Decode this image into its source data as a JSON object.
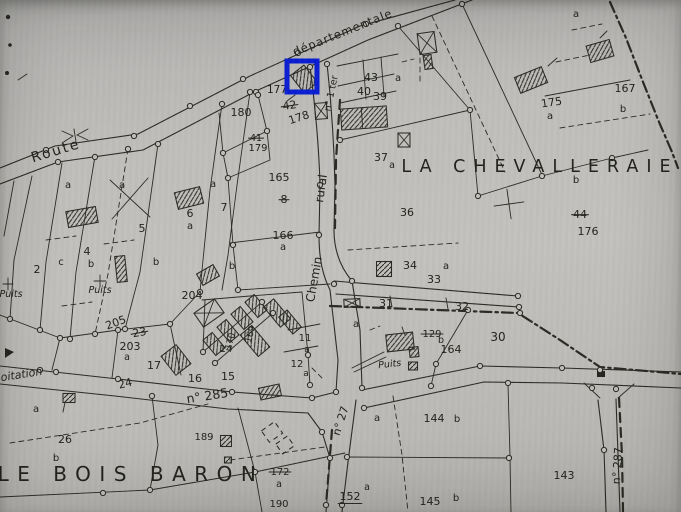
{
  "colors": {
    "paper": "#bfbebb",
    "ink": "#2b2b25",
    "highlight": "#0a1ed2"
  },
  "highlight": {
    "x": 287,
    "y": 61,
    "width": 30,
    "height": 31,
    "stroke_width": 5
  },
  "place_names": [
    {
      "t": "LA CHEVALLERAIE",
      "x": 540,
      "y": 172,
      "s": 17.5,
      "sp": 8,
      "n": "place-la-chevalleraie"
    },
    {
      "t": "LE BOIS BARON",
      "x": 131,
      "y": 481,
      "s": 20,
      "sp": 8.5,
      "n": "place-le-bois-baron"
    }
  ],
  "road_labels": [
    {
      "t": "Route",
      "x": 57,
      "y": 155,
      "r": -17,
      "s": 14,
      "sp": 2,
      "n": "road-route"
    },
    {
      "t": "départementale",
      "x": 344,
      "y": 36,
      "r": -22,
      "s": 11.5,
      "sp": 1,
      "n": "road-departementale"
    },
    {
      "t": "rural",
      "x": 325,
      "y": 189,
      "r": -82,
      "s": 12,
      "n": "road-rural"
    },
    {
      "t": "Chemin",
      "x": 318,
      "y": 280,
      "r": -80,
      "s": 12,
      "n": "road-chemin"
    },
    {
      "t": "n° 1 ter",
      "x": 334,
      "y": 94,
      "r": -78,
      "s": 9.5,
      "n": "road-n1ter"
    },
    {
      "t": "n° 285",
      "x": 208,
      "y": 400,
      "r": -9,
      "s": 12.5,
      "n": "road-n285"
    },
    {
      "t": "24",
      "x": 126,
      "y": 387,
      "r": -14,
      "s": 11,
      "n": "road-mark-24"
    },
    {
      "t": "n° 27",
      "x": 344,
      "y": 422,
      "r": -72,
      "s": 11,
      "n": "road-n27"
    },
    {
      "t": "n° 287",
      "x": 621,
      "y": 466,
      "r": -86,
      "s": 11,
      "n": "road-n287"
    },
    {
      "t": "oitation",
      "x": 22,
      "y": 378,
      "r": -9,
      "s": 11,
      "i": true,
      "n": "road-exploitation"
    }
  ],
  "other_labels": [
    {
      "t": "Puits",
      "x": 100,
      "y": 293,
      "s": 9.5,
      "i": true,
      "n": "well-puits-1"
    },
    {
      "t": "Puits",
      "x": 11,
      "y": 297,
      "s": 9.5,
      "i": true,
      "n": "well-puits-2"
    },
    {
      "t": "Puits",
      "x": 390,
      "y": 367,
      "r": -6,
      "s": 9.5,
      "i": true,
      "n": "well-puits-3"
    }
  ],
  "parcel_labels": [
    {
      "t": "177",
      "x": 277,
      "y": 93,
      "s": 10.5
    },
    {
      "t": "42",
      "x": 290,
      "y": 109,
      "r": -8,
      "k": true
    },
    {
      "t": "178",
      "x": 300,
      "y": 121,
      "r": -18
    },
    {
      "t": "43",
      "x": 371,
      "y": 81
    },
    {
      "t": "40",
      "x": 364,
      "y": 95
    },
    {
      "t": "39",
      "x": 380,
      "y": 100
    },
    {
      "t": "a",
      "x": 398,
      "y": 81,
      "s": 10
    },
    {
      "t": "180",
      "x": 241,
      "y": 116
    },
    {
      "t": "41",
      "x": 256,
      "y": 141,
      "s": 9.5,
      "k": true
    },
    {
      "t": "179",
      "x": 258,
      "y": 151,
      "s": 10
    },
    {
      "t": "a",
      "x": 213,
      "y": 187,
      "s": 10
    },
    {
      "t": "7",
      "x": 224,
      "y": 211
    },
    {
      "t": "6",
      "x": 190,
      "y": 217
    },
    {
      "t": "a",
      "x": 190,
      "y": 229,
      "s": 10
    },
    {
      "t": "165",
      "x": 279,
      "y": 181
    },
    {
      "t": "8",
      "x": 284,
      "y": 203,
      "k": true
    },
    {
      "t": "166",
      "x": 283,
      "y": 239
    },
    {
      "t": "a",
      "x": 283,
      "y": 250,
      "s": 10
    },
    {
      "t": "37",
      "x": 381,
      "y": 161
    },
    {
      "t": "a",
      "x": 392,
      "y": 168,
      "s": 9.5
    },
    {
      "t": "36",
      "x": 407,
      "y": 216
    },
    {
      "t": "b",
      "x": 576,
      "y": 183,
      "s": 10
    },
    {
      "t": "44",
      "x": 580,
      "y": 218,
      "k": true
    },
    {
      "t": "176",
      "x": 588,
      "y": 235
    },
    {
      "t": "a",
      "x": 576,
      "y": 17,
      "s": 10
    },
    {
      "t": "175",
      "x": 552,
      "y": 106,
      "r": -8
    },
    {
      "t": "a",
      "x": 550,
      "y": 119,
      "s": 10
    },
    {
      "t": "167",
      "x": 625,
      "y": 92
    },
    {
      "t": "b",
      "x": 623,
      "y": 112,
      "s": 10
    },
    {
      "t": "a",
      "x": 68,
      "y": 188,
      "s": 10
    },
    {
      "t": "a",
      "x": 122,
      "y": 188,
      "s": 10
    },
    {
      "t": "5",
      "x": 142,
      "y": 232
    },
    {
      "t": "2",
      "x": 37,
      "y": 273
    },
    {
      "t": "c",
      "x": 61,
      "y": 265,
      "s": 10
    },
    {
      "t": "4",
      "x": 87,
      "y": 255
    },
    {
      "t": "b",
      "x": 91,
      "y": 267,
      "s": 10
    },
    {
      "t": "b",
      "x": 156,
      "y": 265,
      "s": 10
    },
    {
      "t": "b",
      "x": 232,
      "y": 269,
      "s": 10
    },
    {
      "t": "204",
      "x": 192,
      "y": 299
    },
    {
      "t": "205",
      "x": 117,
      "y": 326,
      "r": -20
    },
    {
      "t": "23",
      "x": 140,
      "y": 336,
      "r": -10,
      "k": true
    },
    {
      "t": "203",
      "x": 130,
      "y": 350
    },
    {
      "t": "a",
      "x": 127,
      "y": 360,
      "s": 9.5
    },
    {
      "t": "17",
      "x": 154,
      "y": 369
    },
    {
      "t": "16",
      "x": 195,
      "y": 382
    },
    {
      "t": "15",
      "x": 228,
      "y": 380
    },
    {
      "t": "14",
      "x": 226,
      "y": 352,
      "s": 10
    },
    {
      "t": "170",
      "x": 233,
      "y": 342,
      "r": -75,
      "s": 9
    },
    {
      "t": "169",
      "x": 253,
      "y": 335,
      "r": -75,
      "s": 9
    },
    {
      "t": "11",
      "x": 305,
      "y": 341,
      "s": 10
    },
    {
      "t": "a",
      "x": 307,
      "y": 352,
      "s": 9
    },
    {
      "t": "12",
      "x": 297,
      "y": 367,
      "s": 10
    },
    {
      "t": "a",
      "x": 306,
      "y": 376,
      "s": 9
    },
    {
      "t": "34",
      "x": 410,
      "y": 269
    },
    {
      "t": "a",
      "x": 446,
      "y": 269,
      "s": 10
    },
    {
      "t": "33",
      "x": 434,
      "y": 283
    },
    {
      "t": "31",
      "x": 386,
      "y": 307
    },
    {
      "t": "32",
      "x": 462,
      "y": 310
    },
    {
      "t": "a",
      "x": 356,
      "y": 327,
      "s": 10
    },
    {
      "t": "129",
      "x": 432,
      "y": 337,
      "s": 10,
      "k": true
    },
    {
      "t": "b",
      "x": 441,
      "y": 343,
      "s": 9.5
    },
    {
      "t": "164",
      "x": 451,
      "y": 353
    },
    {
      "t": "30",
      "x": 498,
      "y": 341,
      "s": 12
    },
    {
      "t": "a",
      "x": 36,
      "y": 412,
      "s": 10
    },
    {
      "t": "26",
      "x": 65,
      "y": 443
    },
    {
      "t": "b",
      "x": 56,
      "y": 461,
      "s": 10
    },
    {
      "t": "189",
      "x": 204,
      "y": 440,
      "s": 10
    },
    {
      "t": "172",
      "x": 280,
      "y": 475,
      "s": 10,
      "k": true
    },
    {
      "t": "a",
      "x": 279,
      "y": 487,
      "s": 9.5
    },
    {
      "t": "190",
      "x": 279,
      "y": 507,
      "s": 10
    },
    {
      "t": "152",
      "x": 350,
      "y": 500,
      "u": true
    },
    {
      "t": "a",
      "x": 367,
      "y": 490,
      "s": 9.5
    },
    {
      "t": "a",
      "x": 377,
      "y": 421,
      "s": 10
    },
    {
      "t": "144",
      "x": 434,
      "y": 422
    },
    {
      "t": "b",
      "x": 457,
      "y": 422,
      "s": 10
    },
    {
      "t": "145",
      "x": 430,
      "y": 505
    },
    {
      "t": "b",
      "x": 456,
      "y": 501,
      "s": 10
    },
    {
      "t": "143",
      "x": 564,
      "y": 479
    }
  ]
}
